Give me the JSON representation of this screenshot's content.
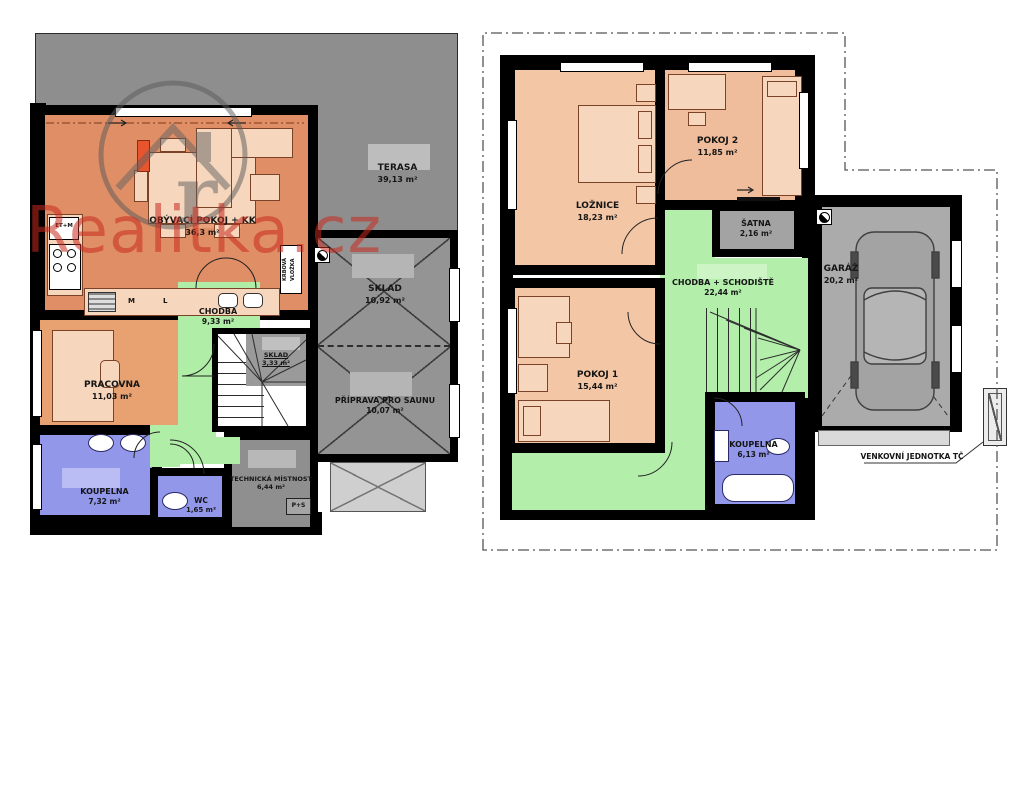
{
  "watermark": {
    "text": "Realitka.cz"
  },
  "ground_floor": {
    "rooms": [
      {
        "name": "TERASA",
        "area": "39,13 m²"
      },
      {
        "name": "OBÝVACÍ POKOJ + KK",
        "area": "36,3 m²"
      },
      {
        "name": "CHODBA",
        "area": "9,33 m²"
      },
      {
        "name": "SKLAD",
        "area": "10,92 m²"
      },
      {
        "name": "PŘÍPRAVA PRO SAUNU",
        "area": "10,07 m²"
      },
      {
        "name": "PRACOVNA",
        "area": "11,03 m²"
      },
      {
        "name": "SKLAD",
        "area": "3,33 m²"
      },
      {
        "name": "KOUPELNA",
        "area": "7,32 m²"
      },
      {
        "name": "WC",
        "area": "1,65 m²"
      },
      {
        "name": "TECHNICKÁ MÍSTNOST",
        "area": "6,44 m²"
      }
    ],
    "small_labels": {
      "fireplace": "KRBOVÁ VLOŽKA",
      "et_m": "ET+M",
      "m": "M",
      "l": "L",
      "p_s": "P+S"
    }
  },
  "upper_floor": {
    "rooms": [
      {
        "name": "LOŽNICE",
        "area": "18,23 m²"
      },
      {
        "name": "POKOJ 2",
        "area": "11,85 m²"
      },
      {
        "name": "ŠATNA",
        "area": "2,16 m²"
      },
      {
        "name": "CHODBA + SCHODIŠTĚ",
        "area": "22,44 m²"
      },
      {
        "name": "POKOJ 1",
        "area": "15,44 m²"
      },
      {
        "name": "KOUPELNA",
        "area": "6,13 m²"
      },
      {
        "name": "GARÁŽ",
        "area": "20,2 m²"
      }
    ],
    "annotation": "VENKOVNÍ JEDNOTKA TČ"
  },
  "colors": {
    "wall": "#000000",
    "room_orange": "#df8e66",
    "room_peach": "#f3c6a5",
    "room_green": "#b0eda7",
    "room_blue": "#9297ea",
    "room_gray": "#949494",
    "watermark_red": "#c92a1e"
  }
}
